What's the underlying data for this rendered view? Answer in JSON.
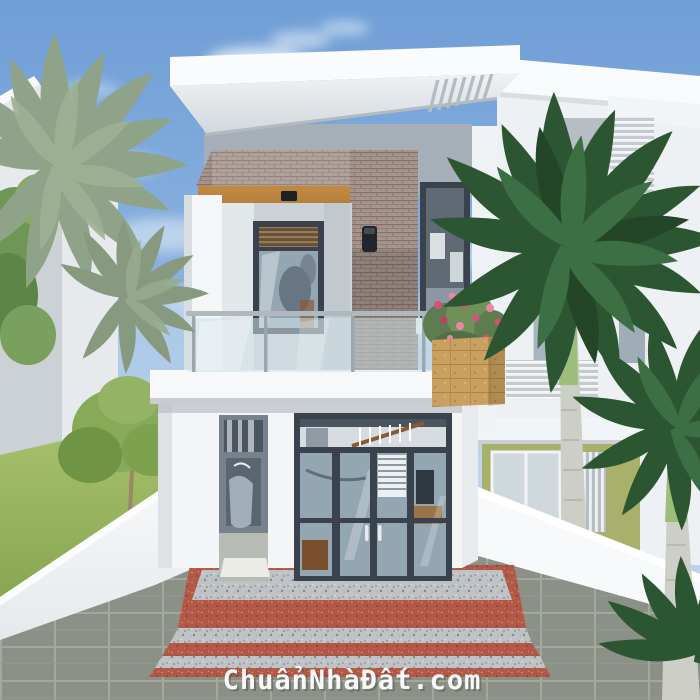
{
  "watermark": {
    "text": "ChuẩnNhàĐất.com",
    "color": "#ffffff"
  },
  "scene": {
    "type": "3d-architectural-render",
    "subject": "Modern two-storey white house, front elevation, glass balcony, brick accent wall, palm trees, granite entry steps, tiled forecourt",
    "objects": [
      "sky with clouds",
      "neighbouring white villas",
      "gray-green palm left",
      "dark green royal palms right",
      "flat roof slab with vent grille",
      "brick accent band and column",
      "wood soffit with ceiling light",
      "balcony window",
      "wall sconce lamp",
      "glass balcony railing",
      "stone flower planter with pink flowers",
      "four-panel glass entry door",
      "narrow side window",
      "red and granite steps",
      "white boundary fences",
      "gray tile walkway"
    ]
  },
  "colors": {
    "sky_top": "#6f9ed6",
    "sky_mid": "#93b9e2",
    "sky_horizon": "#d6e6f2",
    "wall_white": "#f3f5f7",
    "wall_bright": "#fbfcfd",
    "wall_shade": "#dde2e6",
    "parapet_gray": "#a6afb7",
    "brick_base": "#a5938c",
    "wood_soffit": "#c08a42",
    "frame_dark": "#39424d",
    "glass_blue": "#93a6b2",
    "balcony_glass": "#cfe0e6",
    "steel_rail": "#9ba6ad",
    "planter_stone": "#c9a05f",
    "flower_pink": "#d84f78",
    "step_red": "#b25847",
    "granite_gray": "#c0c3c5",
    "walkway_tile": "#8b9186",
    "grass_green": "#9cb768",
    "palm_dark_green": "#2c5632",
    "palm_gray_green": "#8ea387",
    "trunk_gray": "#cdcfc6",
    "neighbor_green_wall": "#a9b06b"
  }
}
